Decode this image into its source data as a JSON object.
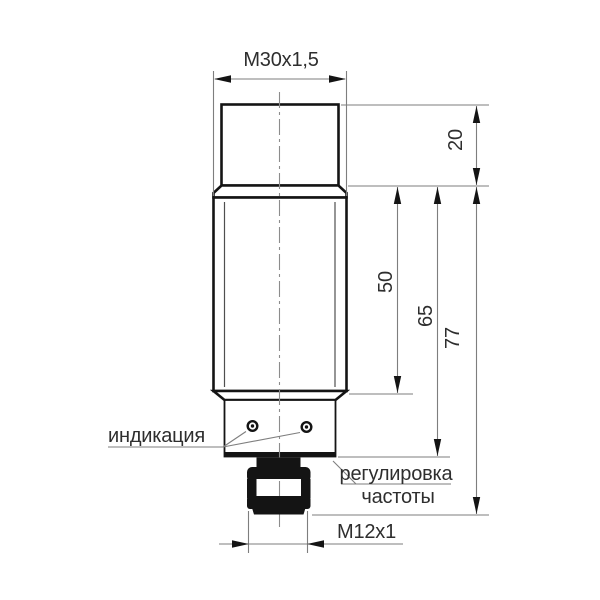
{
  "drawing": {
    "type": "engineering-dimension-drawing",
    "subject": "cylindrical-proximity-sensor-side-view",
    "labels": {
      "thread_top": "M30x1,5",
      "connector_thread": "M12x1",
      "indication": "индикация",
      "adjustment_line1": "регулировка",
      "adjustment_line2": "частоты"
    },
    "dimensions": {
      "thread_length_mm": "20",
      "body_length_mm": "50",
      "body_with_block_mm": "65",
      "total_below_thread_mm": "77"
    },
    "colors": {
      "outline": "#141414",
      "thin_line": "#7e7e7e",
      "text": "#2e2e2e",
      "background": "#ffffff"
    }
  }
}
